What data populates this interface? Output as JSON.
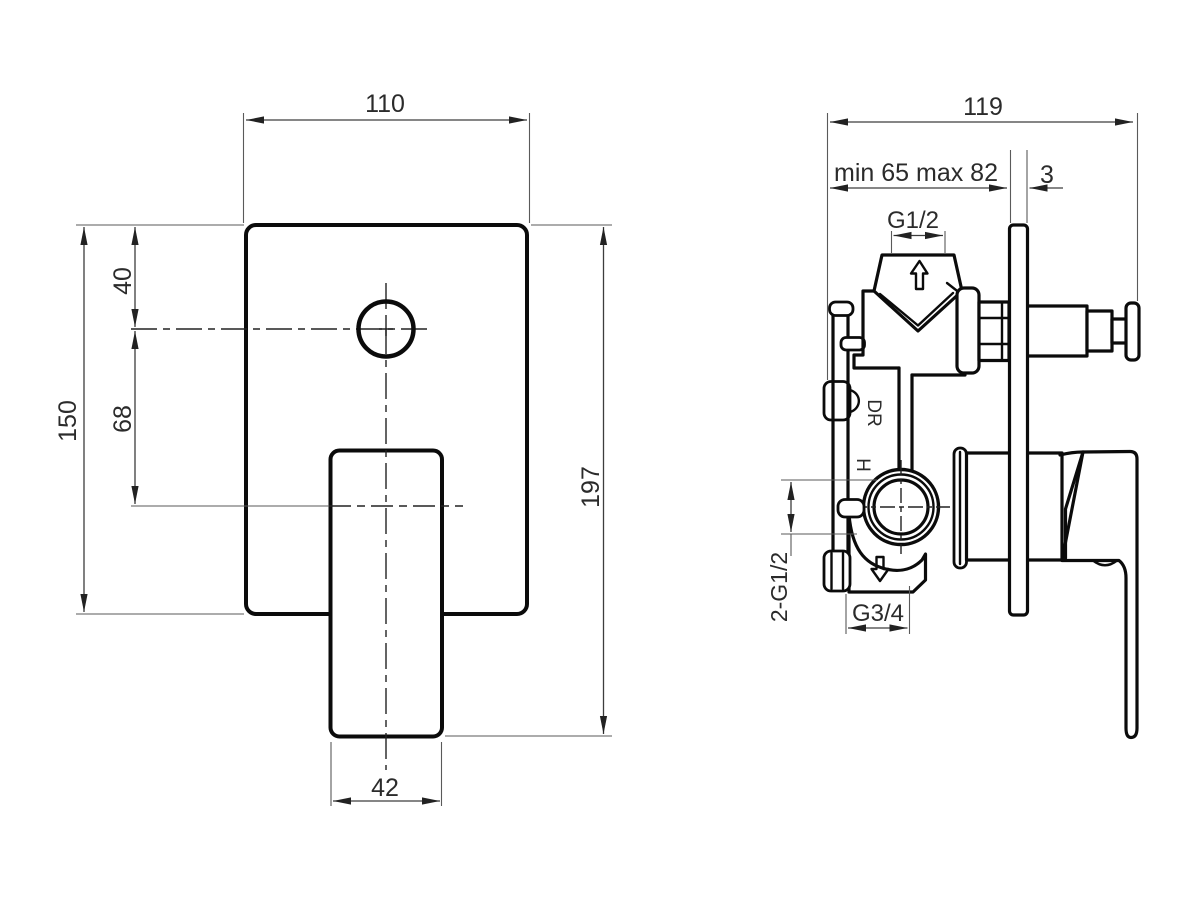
{
  "drawing": {
    "background": "#ffffff",
    "line_color": "#0b0b0b",
    "dimension_color": "#3d3d3d",
    "front_view": {
      "dims": {
        "plate_width": "110",
        "plate_height": "150",
        "hole_offset_from_top": "40",
        "hole_to_lever_axis": "68",
        "total_height": "197",
        "lever_width": "42"
      }
    },
    "side_view": {
      "dims": {
        "total_depth": "119",
        "rough_in_depth": "min 65 max 82",
        "plate_thickness": "3",
        "inlet_thread": "G1/2",
        "outlet_thread": "G3/4",
        "side_connections": "2-G1/2"
      },
      "labels": {
        "drain": "DR",
        "hot": "H"
      }
    }
  }
}
